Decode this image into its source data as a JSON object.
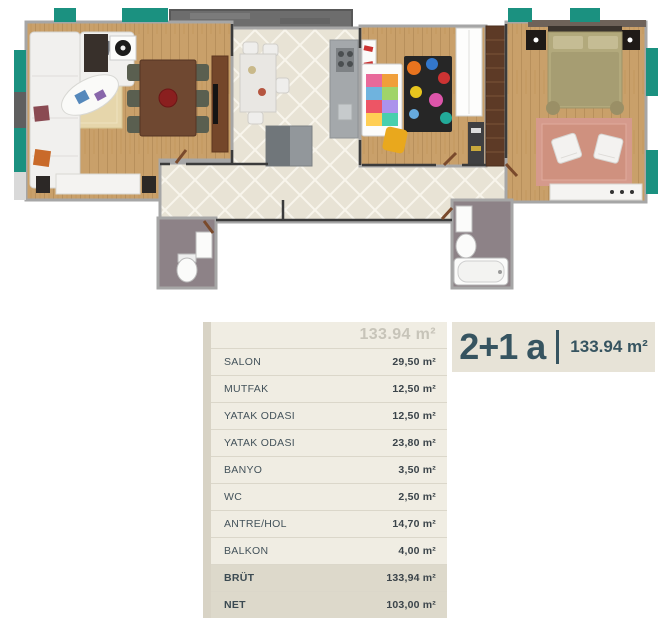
{
  "title": {
    "type_label": "2+1 a",
    "area_label": "133.94 m²"
  },
  "table": {
    "header_total": "133.94 m²",
    "rows": [
      {
        "label": "SALON",
        "value": "29,50 m²"
      },
      {
        "label": "MUTFAK",
        "value": "12,50 m²"
      },
      {
        "label": "YATAK ODASI",
        "value": "12,50 m²"
      },
      {
        "label": "YATAK ODASI",
        "value": "23,80 m²"
      },
      {
        "label": "BANYO",
        "value": "3,50 m²"
      },
      {
        "label": "WC",
        "value": "2,50 m²"
      },
      {
        "label": "ANTRE/HOL",
        "value": "14,70 m²"
      },
      {
        "label": "BALKON",
        "value": "4,00 m²"
      }
    ],
    "summary_rows": [
      {
        "label": "BRÜT",
        "value": "133,94 m²"
      },
      {
        "label": "NET",
        "value": "103,00 m²"
      }
    ]
  },
  "theme": {
    "accent_teal": "#1b9180",
    "table_bg": "#f0ede3",
    "table_spine": "#d8d3c5",
    "summary_bg": "#ddd9cb",
    "title_bg": "#e7e3d7",
    "title_color": "#365460",
    "wood": "#c9a06a",
    "tile": "#e8e3d5",
    "wet_floor": "#8d8287",
    "balcony_gray": "#6d6d6d",
    "wall_line": "#a6a6a6"
  }
}
